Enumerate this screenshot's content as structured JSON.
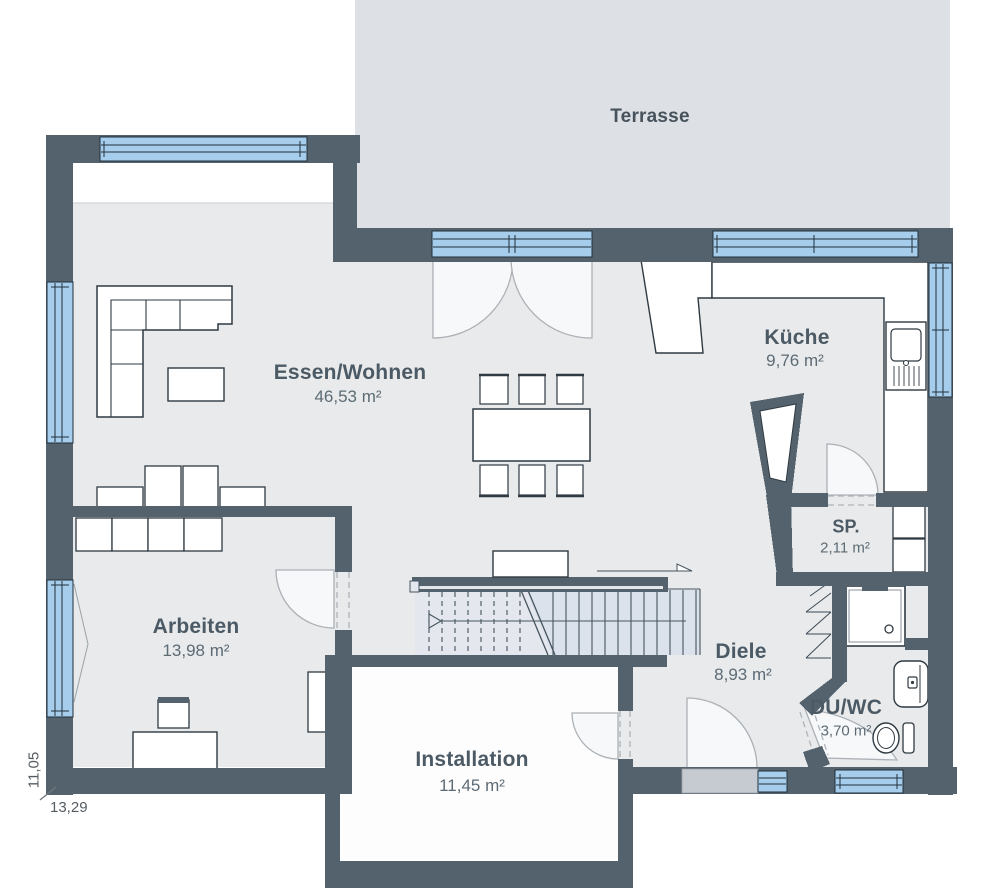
{
  "title": "Erdgeschoss Grundriss",
  "rooms": [
    {
      "id": "terrasse",
      "name": "Terrasse",
      "area": ""
    },
    {
      "id": "essen-wohnen",
      "name": "Essen/Wohnen",
      "area": "46,53 m²"
    },
    {
      "id": "kueche",
      "name": "Küche",
      "area": "9,76 m²"
    },
    {
      "id": "sp",
      "name": "SP.",
      "area": "2,11 m²"
    },
    {
      "id": "arbeiten",
      "name": "Arbeiten",
      "area": "13,98 m²"
    },
    {
      "id": "diele",
      "name": "Diele",
      "area": "8,93 m²"
    },
    {
      "id": "installation",
      "name": "Installation",
      "area": "11,45 m²"
    },
    {
      "id": "du-wc",
      "name": "DU/WC",
      "area": "3,70 m²"
    }
  ],
  "dimensions": {
    "height": "11,05",
    "width": "13,29"
  },
  "colors": {
    "wall": "#54626e",
    "floor": "#e8eaeb",
    "terrace": "#dde1e5",
    "window_glass": "#a6ceec",
    "window_frame": "#22303c",
    "furniture_stroke": "#2f3a42",
    "door_swing": "#abb1b6",
    "entry_slab": "#c5cbd1"
  }
}
